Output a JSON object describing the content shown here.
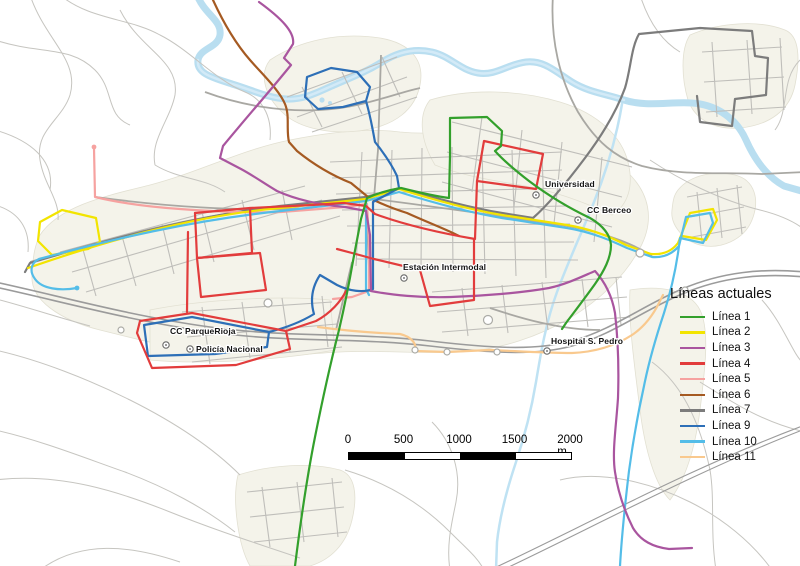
{
  "map": {
    "legend": {
      "title": "Líneas actuales"
    },
    "scalebar": {
      "ticks": [
        "0",
        "500",
        "1000",
        "1500",
        "2000"
      ],
      "unit": "m",
      "tick_meters": 500
    },
    "places": [
      {
        "name": "Universidad",
        "x": 536,
        "y": 195,
        "lx": 545,
        "ly": 187
      },
      {
        "name": "CC Berceo",
        "x": 578,
        "y": 220,
        "lx": 587,
        "ly": 213
      },
      {
        "name": "Estación Intermodal",
        "x": 404,
        "y": 278,
        "lx": 403,
        "ly": 270
      },
      {
        "name": "Hospital S. Pedro",
        "x": 547,
        "y": 351,
        "lx": 551,
        "ly": 344
      },
      {
        "name": "CC ParqueRioja",
        "x": 166,
        "y": 345,
        "lx": 170,
        "ly": 334
      },
      {
        "name": "Policía Nacional",
        "x": 190,
        "y": 349,
        "lx": 196,
        "ly": 352
      }
    ],
    "routes": [
      {
        "id": "linea-7",
        "label": "Línea 7",
        "color": "#7c7c7c",
        "legend_index": 6,
        "paths": [
          "M 25,272 L 30,263 C 110,239 200,215 280,206 L 366,197 L 400,188 C 432,197 466,207 502,213 L 533,218 C 549,204 567,182 585,158 C 603,134 617,110 625,88 C 631,68 631,48 639,34 L 700,28 L 752,31 L 755,56 L 768,58 L 766,95 L 735,99 L 732,126 L 700,122 L 697,96"
        ]
      },
      {
        "id": "linea-11",
        "label": "Línea 11",
        "color": "#f9c98e",
        "legend_index": 9,
        "paths": [
          "M 318,327 C 348,331 374,333 400,334 C 412,337 417,344 415,351 L 447,352 L 490,350 C 516,351 545,353 572,353 C 595,352 615,346 632,335 C 644,327 653,315 659,303 L 663,295"
        ]
      },
      {
        "id": "linea-5",
        "label": "Línea 5",
        "color": "#f6a2a0",
        "legend_index": 4,
        "dots": [
          [
            94,
            147
          ]
        ],
        "paths": [
          "M 94,148 L 95,197 C 120,203 150,207 180,209 C 220,212 250,213 281,212 L 345,207 L 367,204 L 369,240 L 369,291 L 352,297 L 333,299"
        ]
      },
      {
        "id": "linea-6",
        "label": "Línea 6",
        "color": "#a55a22",
        "legend_index": 5,
        "paths": [
          "M 213,0 C 224,24 236,44 250,60 C 264,76 279,90 285,104 C 290,116 286,130 289,142 L 297,151 C 313,164 331,175 351,183 L 368,197 C 381,204 394,209 407,213 C 429,223 448,230 459,236"
        ]
      },
      {
        "id": "linea-2",
        "label": "Línea 2",
        "color": "#f2e400",
        "legend_index": 1,
        "paths": [
          "M 40,222 L 62,210 L 96,218 L 100,242 L 88,249 L 52,255 L 38,241 Z",
          "M 28,268 C 100,243 190,216 280,208 L 366,199 L 399,189 C 431,199 466,209 502,215 L 567,225 C 591,229 611,237 626,245 L 651,254 C 663,255 672,251 678,243 L 690,213 L 713,209 L 717,220 L 706,240 L 682,236 L 678,243"
        ]
      },
      {
        "id": "linea-10",
        "label": "Línea 10",
        "color": "#54bde8",
        "legend_index": 8,
        "dots": [
          [
            77,
            288
          ]
        ],
        "paths": [
          "M 77,288 C 60,291 42,289 35,279 C 29,271 31,263 39,259 C 110,240 192,220 281,211 L 366,201 L 399,192 C 431,202 466,212 502,218 L 567,228 C 592,232 612,241 627,248 L 652,257 C 664,258 673,253 679,246 L 686,217 L 710,213 L 713,223 L 703,243 L 680,238 L 679,246 C 676,269 671,291 664,313 C 656,337 649,361 644,386 C 638,413 633,441 629,471 C 626,496 622,531 620,566",
          "M 366,201 L 366,289 L 369,295"
        ]
      },
      {
        "id": "linea-9",
        "label": "Línea 9",
        "color": "#2d6fb7",
        "legend_index": 7,
        "paths": [
          "M 305,97 L 307,77 L 331,68 L 357,72 L 370,87 L 366,101 L 343,107 L 318,109 L 305,97",
          "M 366,101 C 371,118 373,132 375,142 C 383,152 392,165 397,176 L 399,188 L 373,202 L 373,289 C 363,293 349,291 337,285 L 320,275 C 312,287 310,300 314,314 C 301,322 285,328 269,332 L 267,347 L 215,354 L 148,356 L 144,325 L 192,317 L 269,332"
        ]
      },
      {
        "id": "linea-3",
        "label": "Línea 3",
        "color": "#a9559f",
        "legend_index": 2,
        "paths": [
          "M 259,2 C 281,18 295,32 293,44 L 284,58 L 291,65 C 270,91 246,118 223,146 L 220,158 L 241,169 C 254,176 265,184 277,191 C 297,200 321,205 345,207 L 366,211 L 370,235 L 371,291 C 391,295 421,298 451,297 C 481,296 521,293 549,288 C 567,284 581,277 595,271 C 605,282 612,296 615,313 C 618,339 619,368 618,398 C 616,428 612,452 615,472 C 618,492 625,512 633,528 C 641,541 653,547 669,549 L 692,548"
        ]
      },
      {
        "id": "linea-4",
        "label": "Línea 4",
        "color": "#e23c3c",
        "legend_index": 3,
        "paths": [
          "M 484,141 L 543,154 L 536,189 L 477,181 Z",
          "M 195,213 L 250,208 L 312,205 L 344,203 L 366,206 L 375,214 C 405,225 440,233 475,239 L 477,181",
          "M 474,239 L 474,300 L 430,306 L 420,270 L 374,259 L 352,253 L 337,249",
          "M 195,213 L 197,258 L 252,253 L 250,208",
          "M 197,258 L 260,253 L 266,290 L 201,297 L 197,258",
          "M 188,232 L 187,312",
          "M 140,321 L 192,313 L 286,331 L 290,349 L 236,365 L 152,368 L 137,333 L 140,321",
          "M 286,331 L 316,321 C 331,313 341,301 346,291"
        ]
      },
      {
        "id": "linea-1",
        "label": "Línea 1",
        "color": "#33a02c",
        "legend_index": 0,
        "paths": [
          "M 295,566 C 301,518 307,477 315,437 C 323,397 331,361 339,330 C 345,304 349,284 353,261 L 361,219 L 367,198 C 378,193 389,190 401,188 C 417,192 433,196 449,198 L 450,156 L 450,118 L 487,117 L 502,131 L 501,146 L 495,151 C 504,161 516,171 529,181 C 549,196 571,209 590,218 C 602,225 610,234 611,245 C 611,258 604,271 595,284 C 585,298 575,311 566,323 L 562,329"
        ]
      }
    ]
  }
}
